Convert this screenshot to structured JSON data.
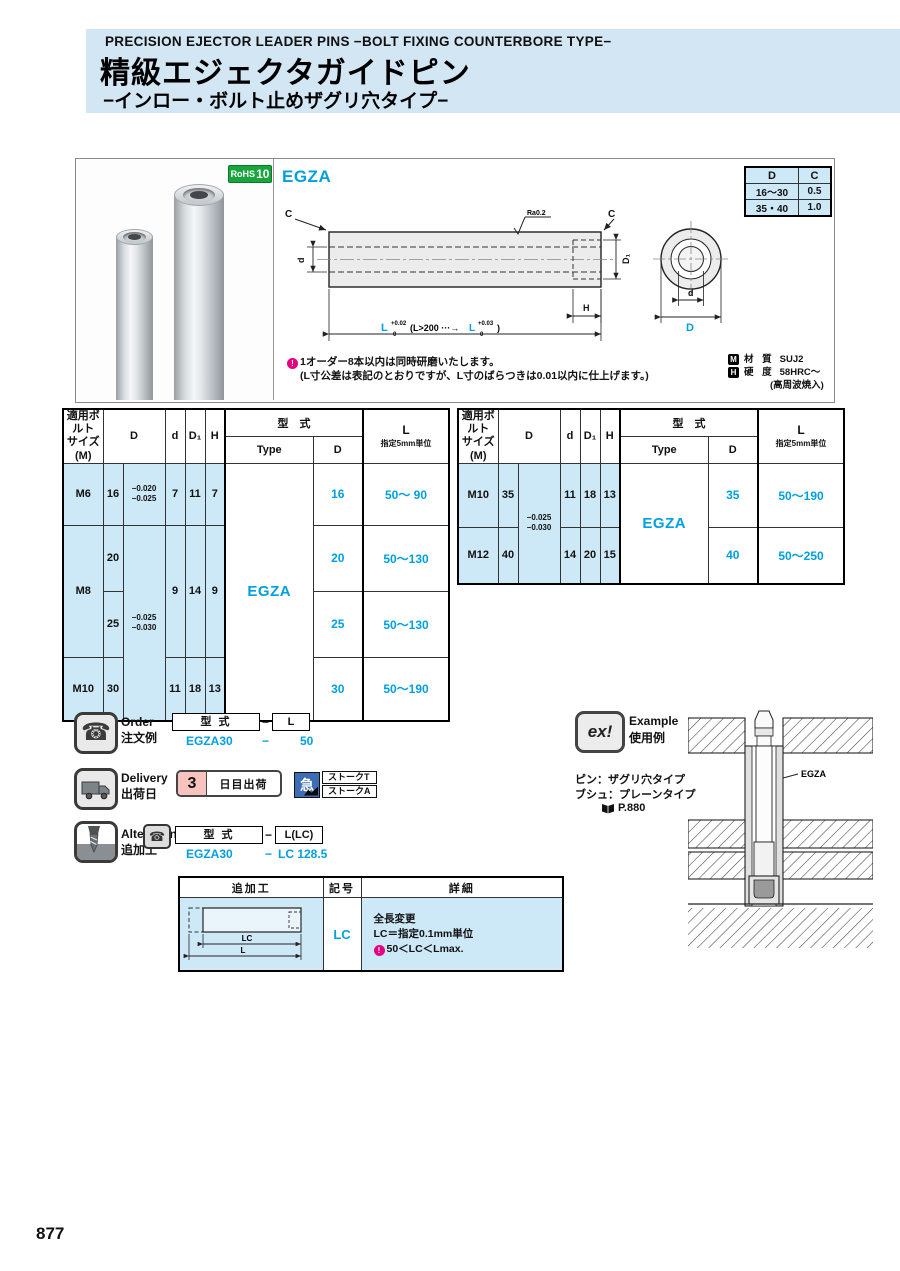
{
  "page_number": "877",
  "colors": {
    "accent_blue": "#00A0E0",
    "band_blue": "#D3E6F4",
    "cell_blue": "#CDE8F7",
    "rohs_green": "#17A53C",
    "note_magenta": "#E4007F",
    "delivery_pink": "#F6C3BE",
    "stork_blue": "#3D6EB5"
  },
  "header": {
    "title_en": "PRECISION EJECTOR LEADER PINS −BOLT FIXING COUNTERBORE TYPE−",
    "title_jp": "精級エジェクタガイドピン",
    "subtitle_jp": "−インロー・ボルト止めザグリ穴タイプ−"
  },
  "product": {
    "rohs": "RoHS",
    "rohs_num": "10",
    "model": "EGZA",
    "dc_table": {
      "header_d": "D",
      "header_c": "C",
      "rows": [
        {
          "d": "16～30",
          "c": "0.5"
        },
        {
          "d": "35・40",
          "c": "1.0"
        }
      ]
    },
    "drawing": {
      "chamfer_left": "C",
      "chamfer_right": "C",
      "surface": "Ra0.2",
      "dim_d": "d",
      "dim_d1": "D₁",
      "dim_h": "H",
      "dim_l": "L",
      "tol1_sup": "+0.02",
      "tol1_sub": "0",
      "l_mid": "(L>200 ···→",
      "dim_l2": "L",
      "tol2_sup": "+0.03",
      "tol2_sub": "0",
      "l_end": ")",
      "end_d": "d",
      "end_big_d": "D"
    },
    "note1": "1オーダー8本以内は同時研磨いたします。",
    "note2": "(L寸公差は表記のとおりですが、L寸のばらつきは0.01以内に仕上げます。)",
    "material_icon": "M",
    "material_label": "材 質",
    "material_value": "SUJ2",
    "hardness_icon": "H",
    "hardness_label": "硬 度",
    "hardness_value": "58HRC～",
    "hardness_note": "(高周波焼入)"
  },
  "spec_header": {
    "bolt1": "適用ボルト",
    "bolt2": "サイズ(M)",
    "d_col": "D",
    "small_d": "d",
    "d1": "D₁",
    "h": "H",
    "model": "型　式",
    "type": "Type",
    "type_d": "D",
    "l1": "L",
    "l2": "指定5mm単位"
  },
  "spec_left": {
    "r0": {
      "bolt": "M6",
      "dv": "16",
      "tol_a": "−0.020",
      "tol_b": "−0.025",
      "d": "7",
      "d1": "11",
      "h": "7",
      "type": "EGZA",
      "td": "16",
      "l": "50～ 90"
    },
    "r1": {
      "bolt": "M8",
      "dv": "20",
      "tol_a": "−0.025",
      "tol_b": "−0.030",
      "d": "9",
      "d1": "14",
      "h": "9",
      "td": "20",
      "l": "50～130"
    },
    "r2": {
      "dv": "25",
      "td": "25",
      "l": "50～130"
    },
    "r3": {
      "bolt": "M10",
      "dv": "30",
      "d": "11",
      "d1": "18",
      "h": "13",
      "td": "30",
      "l": "50～190"
    }
  },
  "spec_right": {
    "r0": {
      "bolt": "M10",
      "dv": "35",
      "tol_a": "−0.025",
      "tol_b": "−0.030",
      "d": "11",
      "d1": "18",
      "h": "13",
      "type": "EGZA",
      "td": "35",
      "l": "50～190"
    },
    "r1": {
      "bolt": "M12",
      "dv": "40",
      "d": "14",
      "d1": "20",
      "h": "15",
      "td": "40",
      "l": "50～250"
    }
  },
  "order": {
    "en": "Order",
    "jp": "注文例",
    "box_model": "型 式",
    "dash": "−",
    "box_l": "L",
    "ex_model": "EGZA30",
    "ex_dash": "−",
    "ex_l": "50"
  },
  "delivery": {
    "en": "Delivery",
    "jp": "出荷日",
    "days": "3",
    "days_label": "日目出荷",
    "express": "急",
    "stork_t": "ストークT",
    "stork_a": "ストークA"
  },
  "alterations": {
    "en": "Alterations",
    "jp": "追加工",
    "box_model": "型 式",
    "dash": "−",
    "box_l": "L(LC)",
    "ex_model": "EGZA30",
    "ex_dash": "−",
    "ex_l": "LC 128.5"
  },
  "lc_table": {
    "h_process": "追加工",
    "h_code": "記号",
    "h_detail": "詳細",
    "code": "LC",
    "detail1": "全長変更",
    "detail2": "LC＝指定0.1mm単位",
    "detail3": "50＜LC＜Lmax.",
    "dim_lc": "LC",
    "dim_l": "L"
  },
  "example": {
    "icon": "ex!",
    "en": "Example",
    "jp": "使用例",
    "note1": "ピン：ザグリ穴タイプ",
    "note2": "ブシュ：プレーンタイプ",
    "ref": "P.880",
    "label": "EGZA"
  }
}
